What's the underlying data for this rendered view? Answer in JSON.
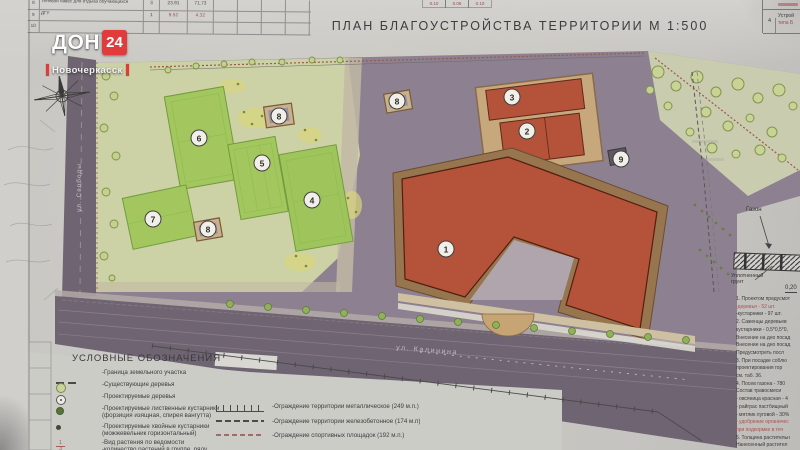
{
  "title": "ПЛАН БЛАГОУСТРОЙСТВА ТЕРРИТОРИИ  М  1:500",
  "overlay": {
    "don": "ДОН",
    "num": "24",
    "city": "Новочеркасск"
  },
  "top_table": {
    "rows": [
      {
        "num": "8",
        "name": "Теневой навес для отдыха обучающихся",
        "qty": "3",
        "v1": "23.91",
        "v2": "71.73",
        "red": false
      },
      {
        "num": "9",
        "name": "ДГУ",
        "qty": "1",
        "v1": "9.52",
        "v2": "4.32",
        "red": true
      },
      {
        "num": "10",
        "name": "",
        "qty": "",
        "v1": "",
        "v2": "",
        "red": false
      }
    ]
  },
  "top_cells": [
    "0.10",
    "0.06",
    "0.10"
  ],
  "corner_table": {
    "num": "4",
    "line1": "Устрой",
    "line2": "типа Б"
  },
  "plan": {
    "street_left": "ул. Свободы",
    "street_bottom": "ул. Калинина",
    "markers": [
      {
        "n": "1",
        "x": 446,
        "y": 249
      },
      {
        "n": "2",
        "x": 527,
        "y": 131
      },
      {
        "n": "3",
        "x": 512,
        "y": 97
      },
      {
        "n": "4",
        "x": 312,
        "y": 200
      },
      {
        "n": "5",
        "x": 262,
        "y": 163
      },
      {
        "n": "6",
        "x": 199,
        "y": 138
      },
      {
        "n": "7",
        "x": 153,
        "y": 219
      },
      {
        "n": "8",
        "x": 279,
        "y": 116
      },
      {
        "n": "8",
        "x": 208,
        "y": 229
      },
      {
        "n": "8",
        "x": 397,
        "y": 101
      },
      {
        "n": "9",
        "x": 621,
        "y": 159
      }
    ]
  },
  "legend": {
    "title": "УСЛОВНЫЕ ОБОЗНАЧЕНИЯ",
    "left_items": [
      {
        "text": "-Граница земельного участка",
        "text2": ""
      },
      {
        "text": "-Существующие деревья",
        "text2": ""
      },
      {
        "text": "-Проектируемые деревья",
        "text2": ""
      },
      {
        "text": "-Проектируемые лиственные кустарники",
        "text2": "(форзиция изящная, спирея вангутта)"
      },
      {
        "text": "-Проектируемые хвойные кустарники",
        "text2": "(можжевельник горизонтальный)"
      },
      {
        "text": "-Вид растения по ведомости",
        "text2": "-количество растений в группе, ряду"
      }
    ],
    "right_items": [
      "-Ограждение территории металлическое (249 м.п.)",
      "-Ограждение территории железобетонное  (174 м.п)",
      "-Ограждение спортивных площадок   (192 м.п.)"
    ]
  },
  "detail": {
    "gazon": "Газон",
    "soil": "Уплотненный грунт",
    "dim": "0,20"
  },
  "notes": {
    "lines": [
      {
        "t": "1. Проектом предусмот",
        "red": false
      },
      {
        "t": "-деревья - 52 шт.",
        "red": true
      },
      {
        "t": "-кустарники - 97 шт.",
        "red": false
      },
      {
        "t": "2. Саженцы деревьев",
        "red": false
      },
      {
        "t": "кустарники - 0,5*0,5*0,",
        "red": false
      },
      {
        "t": "Внесение на дно посад",
        "red": false
      },
      {
        "t": "Внесение на дно посад",
        "red": false
      },
      {
        "t": "Предусмотреть посл",
        "red": false
      },
      {
        "t": "3. При посадке соблю",
        "red": false
      },
      {
        "t": "проектирования гор",
        "red": false
      },
      {
        "t": "см. таб. 36.",
        "red": false
      },
      {
        "t": "4. Посев газона - 780",
        "red": false
      },
      {
        "t": "Состав травосмеси",
        "red": false
      },
      {
        "t": "- овсяница красная - 4",
        "red": false
      },
      {
        "t": "- райграс пастбищный",
        "red": false
      },
      {
        "t": "- мятлик луговой - 30%",
        "red": false
      },
      {
        "t": "- удобрение органичес",
        "red": true
      },
      {
        "t": "при подкормке в теч",
        "red": true
      },
      {
        "t": "5. Толщина растительн",
        "red": false
      },
      {
        "t": "Нанесенный растител",
        "red": false
      }
    ]
  }
}
